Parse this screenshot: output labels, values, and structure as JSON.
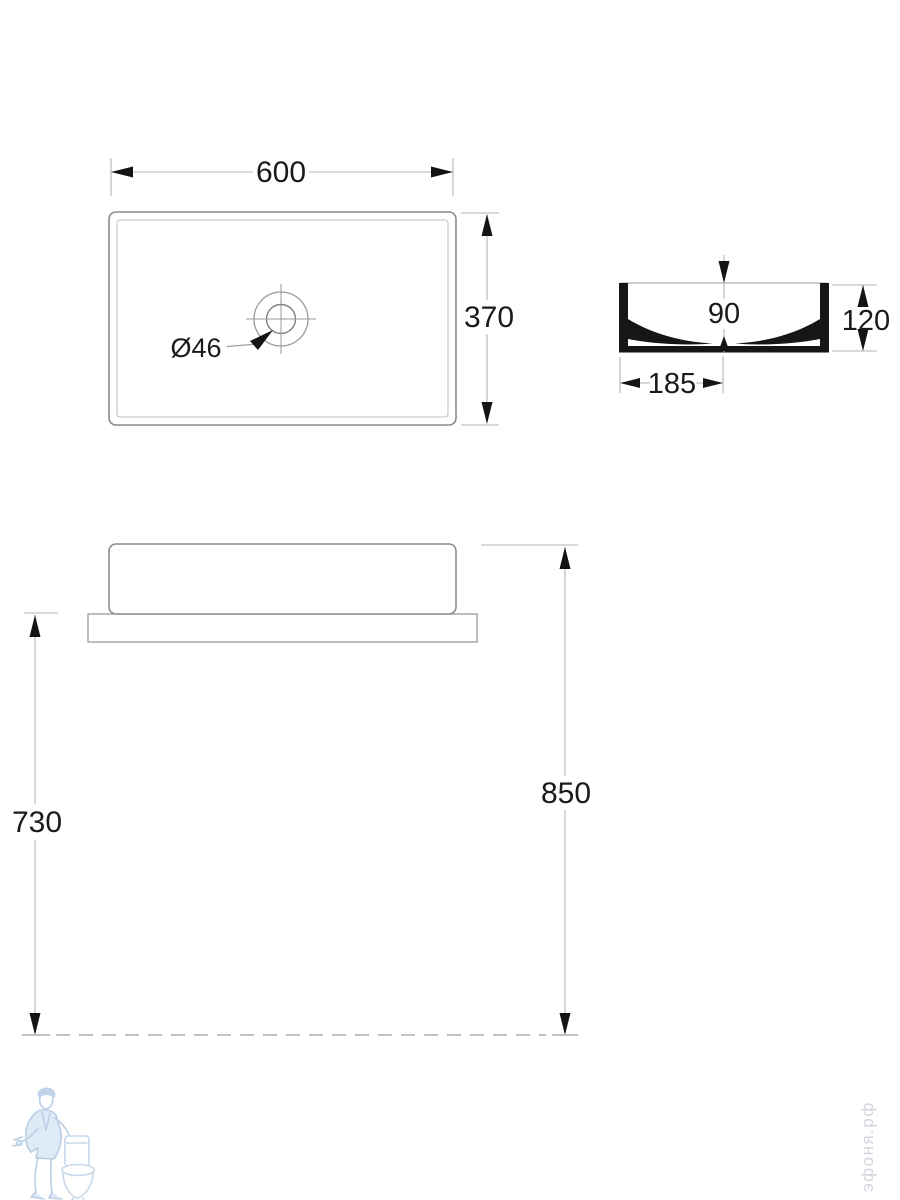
{
  "plan_view": {
    "width": "600",
    "depth": "370",
    "drain_diameter": "Ø46"
  },
  "section_view": {
    "inner_depth": "90",
    "overall_height": "120",
    "drain_offset": "185"
  },
  "front_view": {
    "counter_height": "730",
    "rim_height": "850"
  },
  "watermarks": {
    "site": "эфоня.рф",
    "logo_icon": "plumber-with-toilet-icon"
  },
  "colors": {
    "background": "#ffffff",
    "outline": "#8a8a8a",
    "thin_line": "#bcbcbc",
    "dim_line": "#b4b4b4",
    "section_fill": "#161616",
    "text": "#1a1a1a",
    "watermark_text": "#d4d4dc",
    "logo_blue_stroke": "#a3c0dc",
    "logo_blue_fill": "#d3e3f2"
  }
}
